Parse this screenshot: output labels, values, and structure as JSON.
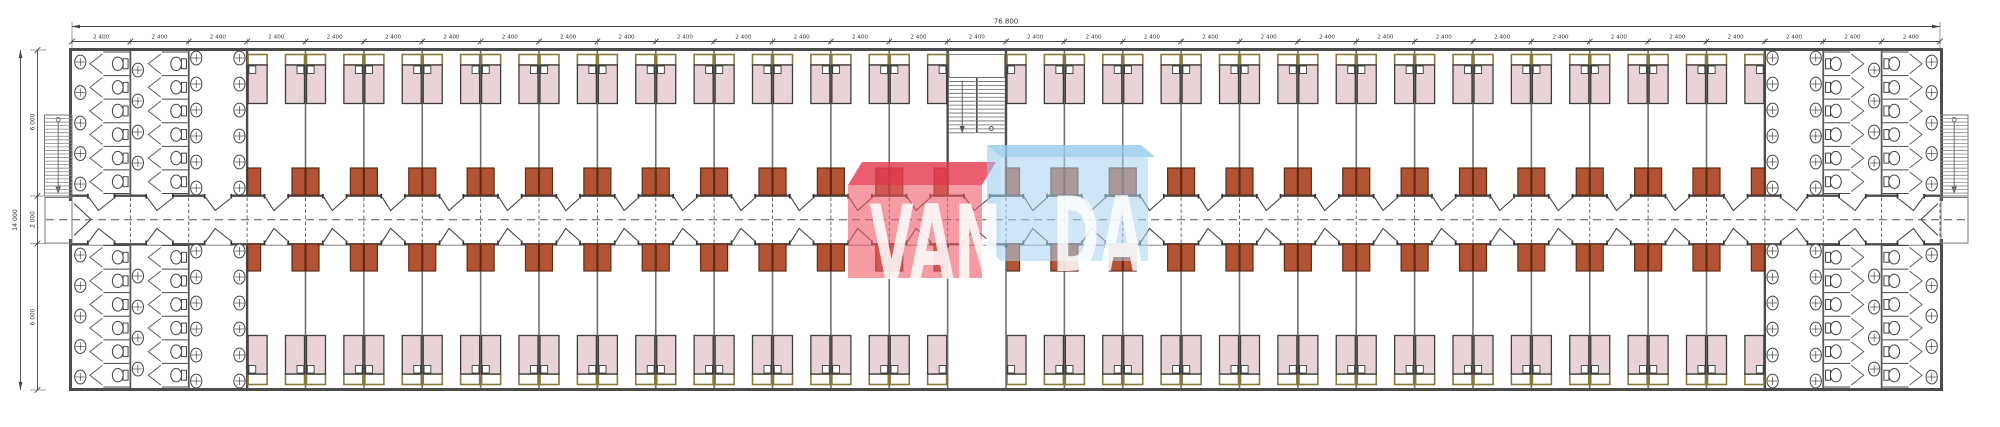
{
  "document": {
    "type": "architectural-floor-plan",
    "watermark": {
      "left_text": "VAN",
      "right_text": "DA"
    }
  },
  "dimensions": {
    "top_total": "76 800",
    "top_bay": "2 400",
    "bay_count": 32,
    "left_total": "14 000",
    "left_segments": [
      "6 000",
      "2 000",
      "6 000"
    ]
  },
  "plan": {
    "bathroom_bays_per_end": 3,
    "stair_bay_index": 16,
    "bedrooms_top_band": 25,
    "bedrooms_bottom_band": 25,
    "beds_per_room": 2,
    "fixtures": {
      "toilet_stall_columns_per_block": 2,
      "stalls_per_column": 6,
      "sink_column_counts": [
        5,
        4,
        6,
        6
      ],
      "bathroom_blocks": 4
    },
    "stairs": {
      "external": 2,
      "internal": 1
    }
  },
  "colors": {
    "wall": "#4c4c4c",
    "partition": "#6f6f6f",
    "line": "#444444",
    "stair_line": "#777777",
    "bed_fill": "#e9d3d7",
    "bed_stroke": "#3d3d3d",
    "headboard_stroke": "#8a7a3c",
    "pillow_fill": "#ffffff",
    "cabinet_fill": "#b25434",
    "cabinet_stroke": "#5f2c16",
    "dash": "#555555",
    "fixture": "#444444",
    "dim_text": "#333333",
    "wm_red_top": "#e63b52",
    "wm_red_front": "#ee5868",
    "wm_blue_top": "#95cbeb",
    "wm_blue_front": "#a6d2ee",
    "wm_text": "#ffffff"
  }
}
